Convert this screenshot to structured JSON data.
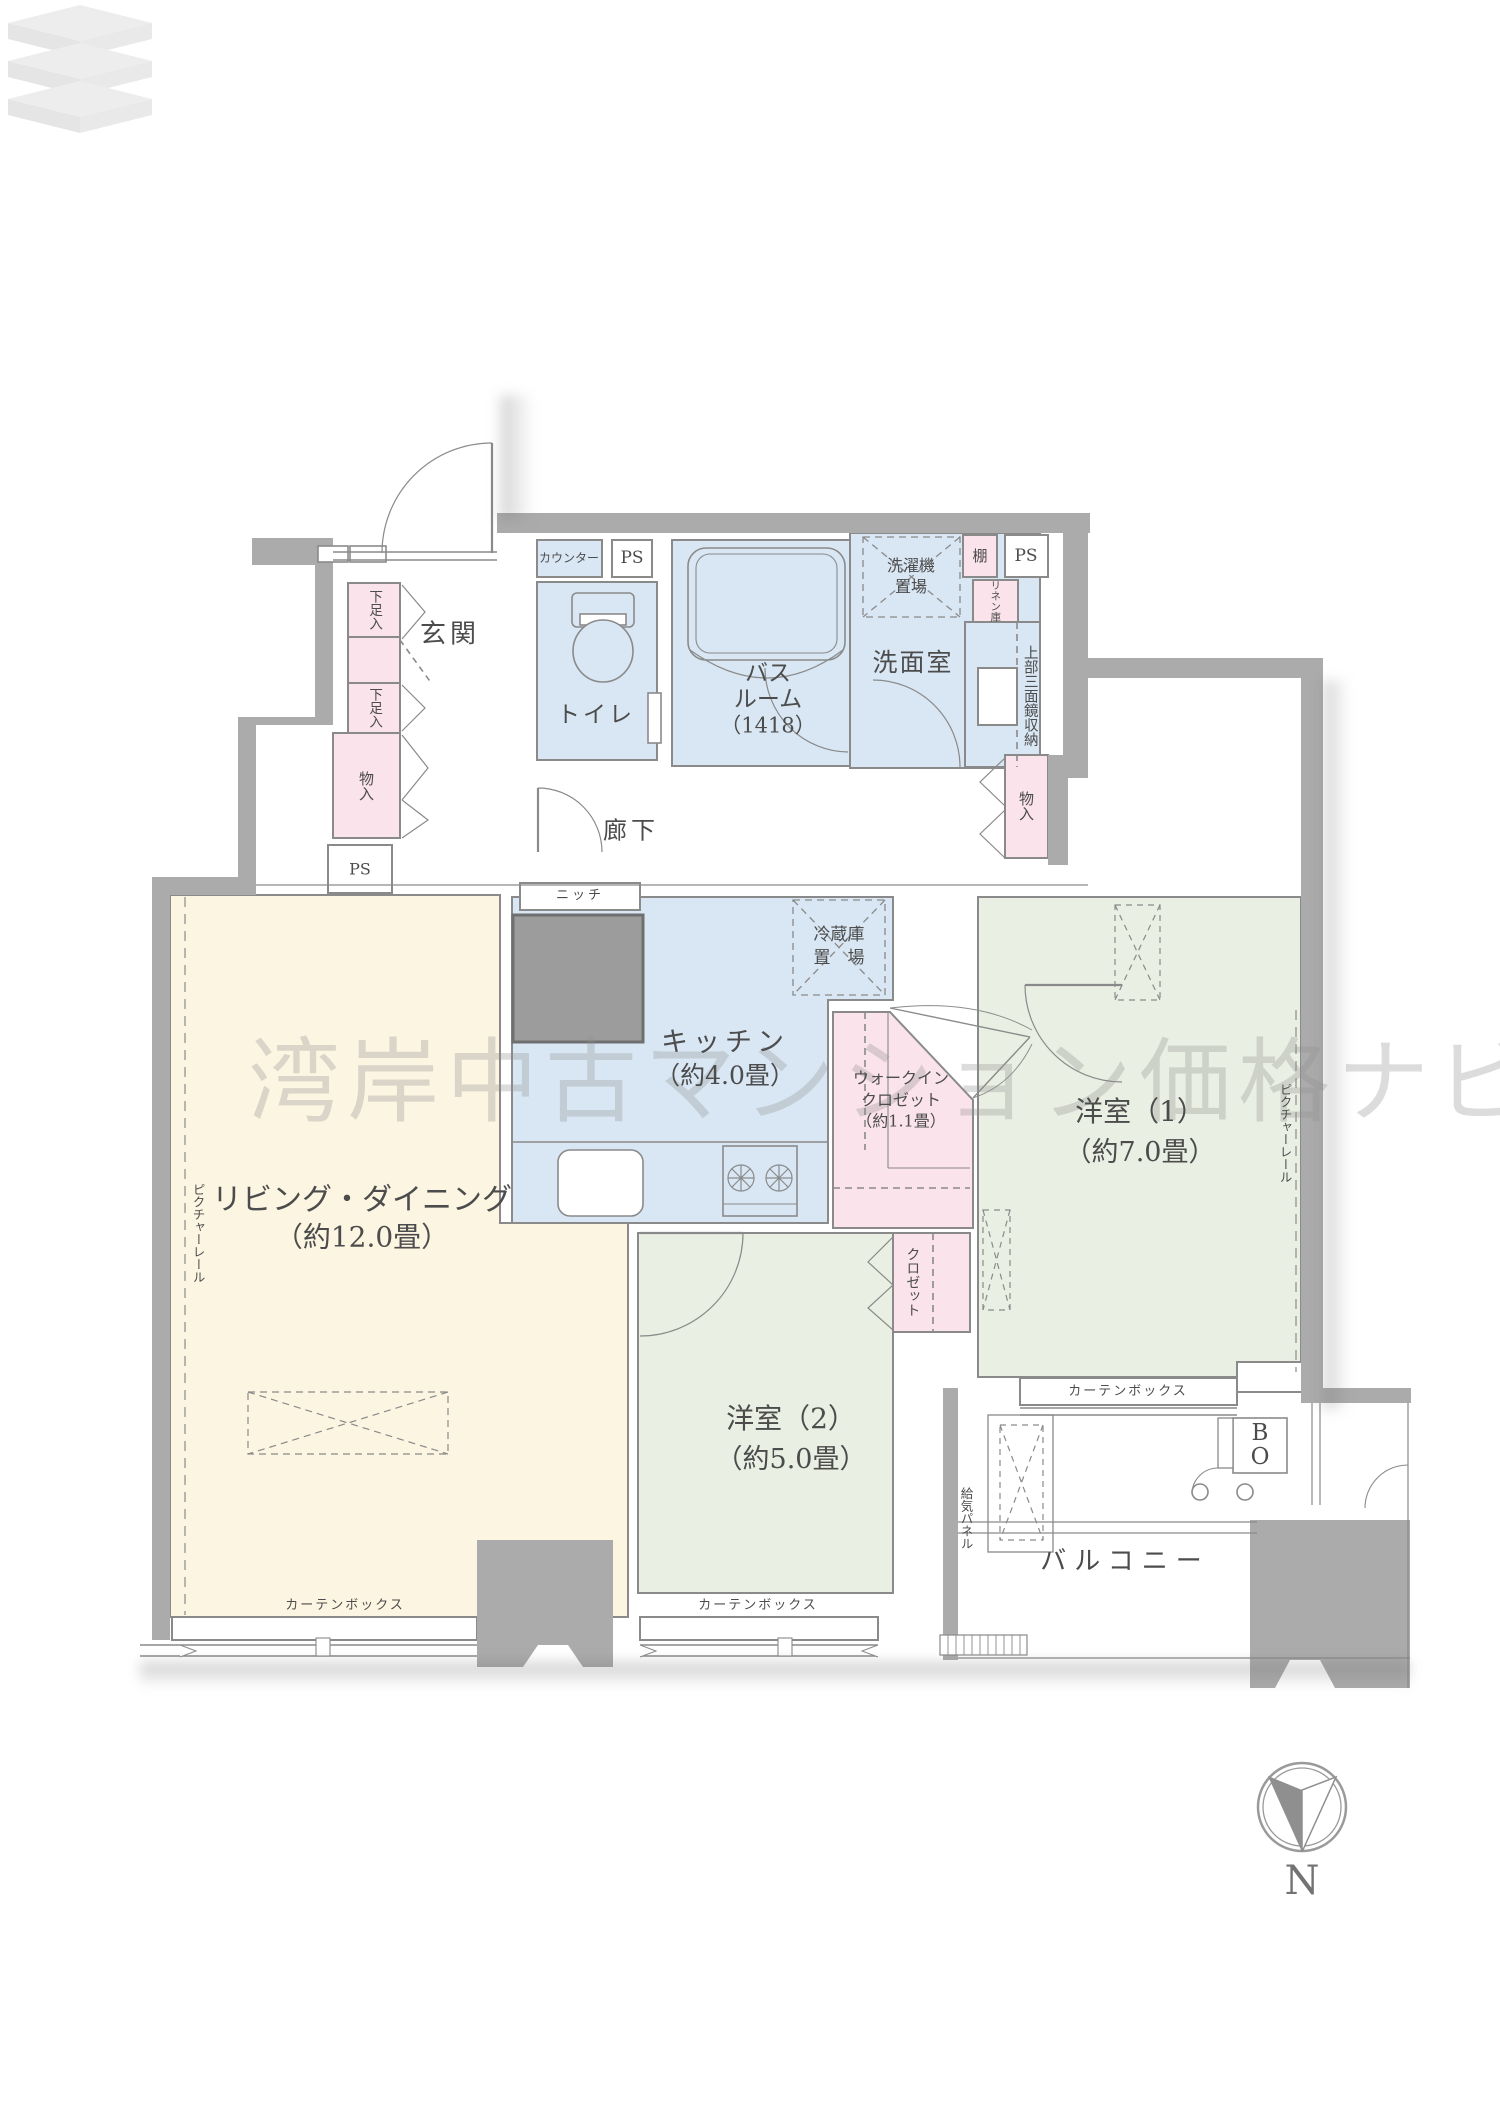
{
  "watermark": {
    "text": "湾岸中古マンション価格ナビ"
  },
  "compass": {
    "label": "N"
  },
  "rooms": {
    "entrance": {
      "label": "玄関"
    },
    "hallway": {
      "label": "廊下"
    },
    "toilet": {
      "label": "トイレ"
    },
    "bathroom": {
      "line1": "バス",
      "line2": "ルーム",
      "line3": "（1418）"
    },
    "washroom": {
      "label": "洗面室"
    },
    "kitchen": {
      "label": "キッチン",
      "size": "（約4.0畳）"
    },
    "living_dining": {
      "label": "リビング・ダイニング",
      "size": "（約12.0畳）"
    },
    "bedroom1": {
      "label": "洋室（1）",
      "size": "（約7.0畳）"
    },
    "bedroom2": {
      "label": "洋室（2）",
      "size": "（約5.0畳）"
    },
    "walkin_closet": {
      "line1": "ウォークイン",
      "line2": "クロゼット",
      "line3": "（約1.1畳）"
    },
    "balcony": {
      "label": "バルコニー"
    }
  },
  "fixtures": {
    "counter": "カウンター",
    "ps": "PS",
    "shelf": "棚",
    "linen_cabinet": "リネン庫",
    "mirror_cabinet": "上部三面鏡収納",
    "laundry_line1": "洗濯機",
    "laundry_line2": "置場",
    "fridge_line1": "冷蔵庫",
    "fridge_line2": "置　場",
    "shoe_cabinet": "下足入",
    "storage": "物入",
    "niche": "ニッチ",
    "closet": "クロゼット",
    "picture_rail": "ピクチャーレール",
    "curtain_box": "カーテンボックス",
    "air_supply_panel": "給気パネル",
    "bo_line1": "B",
    "bo_line2": "O"
  },
  "colors": {
    "wet_area_blue": "#d9e7f4",
    "closet_pink": "#fae3ea",
    "bedroom_green": "#e9efe2",
    "living_cream": "#fcf5e1",
    "wall_gray": "#ababab",
    "line_gray": "#8a8a8a",
    "dark_block": "#9c9c9c",
    "text_gray": "#4c4c4c"
  }
}
